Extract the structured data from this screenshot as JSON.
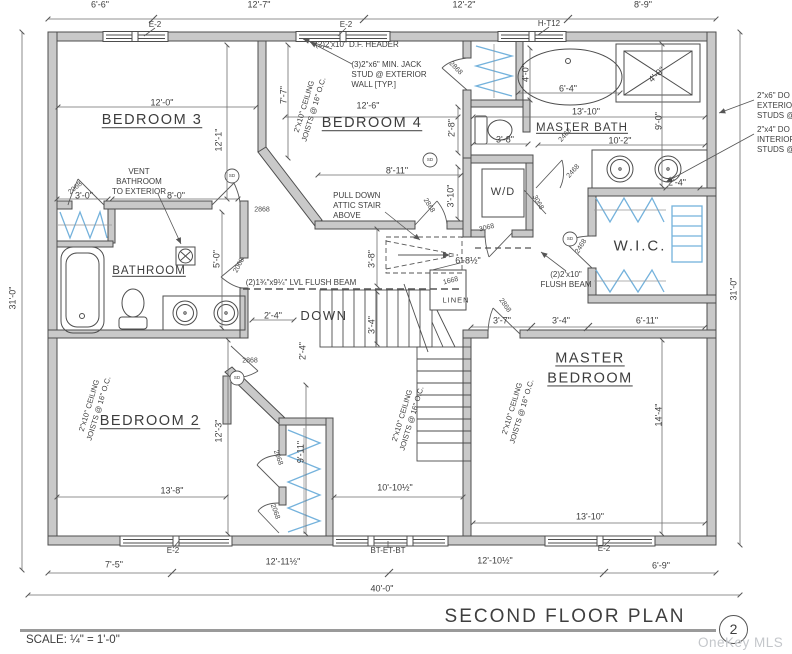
{
  "meta": {
    "title": "SECOND FLOOR PLAN",
    "sheet_number": "2",
    "scale": "SCALE: ¼\" = 1'-0\"",
    "watermark": "OneKey MLS"
  },
  "colors": {
    "wall": "#c9c9c9",
    "line": "#4d4d4d",
    "shelving": "#74b2dc",
    "watermark_gray": "#c4c7cb"
  },
  "labels": [
    {
      "t": "6'-6\"",
      "x": 100,
      "y": 5,
      "c": "dim"
    },
    {
      "t": "12'-7\"",
      "x": 259,
      "y": 5,
      "c": "dim"
    },
    {
      "t": "12'-2\"",
      "x": 464,
      "y": 5,
      "c": "dim"
    },
    {
      "t": "8'-9\"",
      "x": 643,
      "y": 5,
      "c": "dim"
    },
    {
      "t": "E-2",
      "x": 155,
      "y": 25,
      "c": "tag"
    },
    {
      "t": "E-2",
      "x": 346,
      "y": 25,
      "c": "tag"
    },
    {
      "t": "H-T12",
      "x": 549,
      "y": 24,
      "c": "tag"
    },
    {
      "t": "31'-0\"",
      "x": 13,
      "y": 298,
      "r": -90,
      "c": "dim"
    },
    {
      "t": "31'-0\"",
      "x": 734,
      "y": 289,
      "r": -90,
      "c": "dim"
    },
    {
      "t": "12'-0\"",
      "x": 162,
      "y": 103,
      "c": "dim"
    },
    {
      "t": "BEDROOM 3",
      "x": 152,
      "y": 121,
      "c": "room"
    },
    {
      "t": "12'-1\"",
      "x": 219,
      "y": 140,
      "r": -90,
      "c": "dim"
    },
    {
      "t": "3'-0\"",
      "x": 84,
      "y": 196,
      "c": "dim"
    },
    {
      "t": "8'-0\"",
      "x": 176,
      "y": 196,
      "c": "dim"
    },
    {
      "t": "2068",
      "x": 76,
      "y": 189,
      "r": -40,
      "c": "door"
    },
    {
      "t": "VENT\nBATHROOM\nTO EXTERIOR",
      "x": 139,
      "y": 182,
      "c": "notec"
    },
    {
      "t": "(2)2'x10\" D.F. HEADER",
      "x": 357,
      "y": 45,
      "c": "notec"
    },
    {
      "t": "(3)2\"x6\" MIN. JACK\nSTUD @ EXTERIOR\nWALL [TYP.]",
      "x": 389,
      "y": 75,
      "c": "note"
    },
    {
      "t": "7'-7\"",
      "x": 284,
      "y": 95,
      "r": -90,
      "c": "dim"
    },
    {
      "t": "2\"x10\" CEILING\nJOISTS @ 16\" O.C.",
      "x": 309,
      "y": 108,
      "r": -73,
      "c": "joist"
    },
    {
      "t": "12'-6\"",
      "x": 368,
      "y": 106,
      "c": "dim"
    },
    {
      "t": "BEDROOM 4",
      "x": 372,
      "y": 124,
      "c": "room"
    },
    {
      "t": "8'-11\"",
      "x": 397,
      "y": 171,
      "c": "dim"
    },
    {
      "t": "PULL DOWN\nATTIC STAIR\nABOVE",
      "x": 357,
      "y": 206,
      "c": "note"
    },
    {
      "t": "2868",
      "x": 455,
      "y": 69,
      "r": 45,
      "c": "door"
    },
    {
      "t": "2868",
      "x": 428,
      "y": 206,
      "r": 58,
      "c": "door"
    },
    {
      "t": "2868",
      "x": 262,
      "y": 211,
      "c": "door"
    },
    {
      "t": "4'-0\"",
      "x": 526,
      "y": 73,
      "r": -90,
      "c": "dim"
    },
    {
      "t": "6'-4\"",
      "x": 568,
      "y": 89,
      "c": "dim"
    },
    {
      "t": "4'-0\"",
      "x": 657,
      "y": 75,
      "r": -42,
      "c": "dim"
    },
    {
      "t": "13'-10\"",
      "x": 586,
      "y": 112,
      "c": "dim"
    },
    {
      "t": "MASTER BATH",
      "x": 582,
      "y": 128,
      "c": "rmmd"
    },
    {
      "t": "9'-0\"",
      "x": 659,
      "y": 121,
      "r": -90,
      "c": "dim"
    },
    {
      "t": "10'-2\"",
      "x": 620,
      "y": 141,
      "c": "dim"
    },
    {
      "t": "3'-8\"",
      "x": 505,
      "y": 140,
      "c": "dim"
    },
    {
      "t": "2'-8\"",
      "x": 452,
      "y": 128,
      "r": -90,
      "c": "dim"
    },
    {
      "t": "2'-4\"",
      "x": 677,
      "y": 183,
      "c": "dim"
    },
    {
      "t": "2468",
      "x": 566,
      "y": 136,
      "r": -48,
      "c": "door"
    },
    {
      "t": "2468",
      "x": 574,
      "y": 172,
      "r": -48,
      "c": "door"
    },
    {
      "t": "3'-10\"",
      "x": 451,
      "y": 196,
      "r": -90,
      "c": "dim"
    },
    {
      "t": "W/D",
      "x": 503,
      "y": 193,
      "c": "wd"
    },
    {
      "t": "3068",
      "x": 487,
      "y": 229,
      "r": -14,
      "c": "door"
    },
    {
      "t": "3068",
      "x": 537,
      "y": 203,
      "r": 60,
      "c": "door"
    },
    {
      "t": "W.I.C.",
      "x": 640,
      "y": 247,
      "c": "wic"
    },
    {
      "t": "2468",
      "x": 582,
      "y": 247,
      "r": -58,
      "c": "door"
    },
    {
      "t": "(2)2'x10\"\nFLUSH BEAM",
      "x": 566,
      "y": 280,
      "c": "notec"
    },
    {
      "t": "3'-8\"",
      "x": 372,
      "y": 259,
      "r": -90,
      "c": "dim"
    },
    {
      "t": "6'-8½\"",
      "x": 468,
      "y": 261,
      "c": "dim"
    },
    {
      "t": "(2)1¾\"x9¼\" LVL FLUSH BEAM",
      "x": 301,
      "y": 283,
      "c": "notec"
    },
    {
      "t": "2'-4\"",
      "x": 273,
      "y": 316,
      "c": "dim"
    },
    {
      "t": "DOWN",
      "x": 324,
      "y": 316,
      "c": "down"
    },
    {
      "t": "3'-4\"",
      "x": 372,
      "y": 325,
      "r": -90,
      "c": "dim"
    },
    {
      "t": "1668",
      "x": 451,
      "y": 282,
      "r": -14,
      "c": "door"
    },
    {
      "t": "LINEN",
      "x": 456,
      "y": 300,
      "c": "linen"
    },
    {
      "t": "2068",
      "x": 240,
      "y": 266,
      "r": -62,
      "c": "door"
    },
    {
      "t": "5'-0\"",
      "x": 217,
      "y": 259,
      "r": -90,
      "c": "dim"
    },
    {
      "t": "BATHROOM",
      "x": 149,
      "y": 271,
      "c": "rmmd"
    },
    {
      "t": "BEDROOM 2",
      "x": 150,
      "y": 422,
      "c": "room"
    },
    {
      "t": "2\"x10\" CEILING\nJOISTS @ 16\" O.C.",
      "x": 94,
      "y": 407,
      "r": -73,
      "c": "joist"
    },
    {
      "t": "2\"x10\" CEILING\nJOISTS @ 16\" O.C.",
      "x": 407,
      "y": 417,
      "r": -73,
      "c": "joist"
    },
    {
      "t": "2\"x10\" CEILING\nJOISTS @ 16\" O.C.",
      "x": 517,
      "y": 410,
      "r": -73,
      "c": "joist"
    },
    {
      "t": "12'-3\"",
      "x": 219,
      "y": 431,
      "r": -90,
      "c": "dim"
    },
    {
      "t": "13'-8\"",
      "x": 172,
      "y": 491,
      "c": "dim"
    },
    {
      "t": "10'-10½\"",
      "x": 395,
      "y": 488,
      "c": "dim"
    },
    {
      "t": "2'-4\"",
      "x": 303,
      "y": 351,
      "r": -90,
      "c": "dim"
    },
    {
      "t": "9'-11\"",
      "x": 301,
      "y": 452,
      "r": -90,
      "c": "dim"
    },
    {
      "t": "2868",
      "x": 250,
      "y": 362,
      "c": "door"
    },
    {
      "t": "2068",
      "x": 277,
      "y": 458,
      "r": 70,
      "c": "door"
    },
    {
      "t": "2068",
      "x": 274,
      "y": 512,
      "r": 70,
      "c": "door"
    },
    {
      "t": "3'-7\"",
      "x": 502,
      "y": 321,
      "c": "dim"
    },
    {
      "t": "3'-4\"",
      "x": 561,
      "y": 321,
      "c": "dim"
    },
    {
      "t": "6'-11\"",
      "x": 647,
      "y": 321,
      "c": "dim"
    },
    {
      "t": "MASTER\nBEDROOM",
      "x": 590,
      "y": 369,
      "c": "room"
    },
    {
      "t": "14'-4\"",
      "x": 659,
      "y": 415,
      "r": -90,
      "c": "dim"
    },
    {
      "t": "13'-10\"",
      "x": 590,
      "y": 517,
      "c": "dim"
    },
    {
      "t": "2868",
      "x": 504,
      "y": 306,
      "r": 55,
      "c": "door"
    },
    {
      "t": "2\"x6\" DO\nEXTERIOR\nSTUDS @",
      "x": 757,
      "y": 106,
      "c": "note",
      "a": "l"
    },
    {
      "t": "2\"x4\" DO\nINTERIOR\nSTUDS @",
      "x": 757,
      "y": 140,
      "c": "note",
      "a": "l"
    },
    {
      "t": "E-2",
      "x": 173,
      "y": 551,
      "c": "tag"
    },
    {
      "t": "BT-ET-BT",
      "x": 388,
      "y": 551,
      "c": "tag"
    },
    {
      "t": "E-2",
      "x": 604,
      "y": 549,
      "c": "tag"
    },
    {
      "t": "7'-5\"",
      "x": 114,
      "y": 565,
      "c": "dim"
    },
    {
      "t": "12'-11½\"",
      "x": 283,
      "y": 562,
      "c": "dim"
    },
    {
      "t": "12'-10½\"",
      "x": 495,
      "y": 561,
      "c": "dim"
    },
    {
      "t": "6'-9\"",
      "x": 661,
      "y": 566,
      "c": "dim"
    },
    {
      "t": "40'-0\"",
      "x": 382,
      "y": 589,
      "c": "dim"
    },
    {
      "t": "SD",
      "x": 232,
      "y": 176,
      "c": "sd"
    },
    {
      "t": "SD",
      "x": 430,
      "y": 160,
      "c": "sd"
    },
    {
      "t": "SD",
      "x": 570,
      "y": 239,
      "c": "sd"
    },
    {
      "t": "SD",
      "x": 237,
      "y": 378,
      "c": "sd"
    }
  ]
}
